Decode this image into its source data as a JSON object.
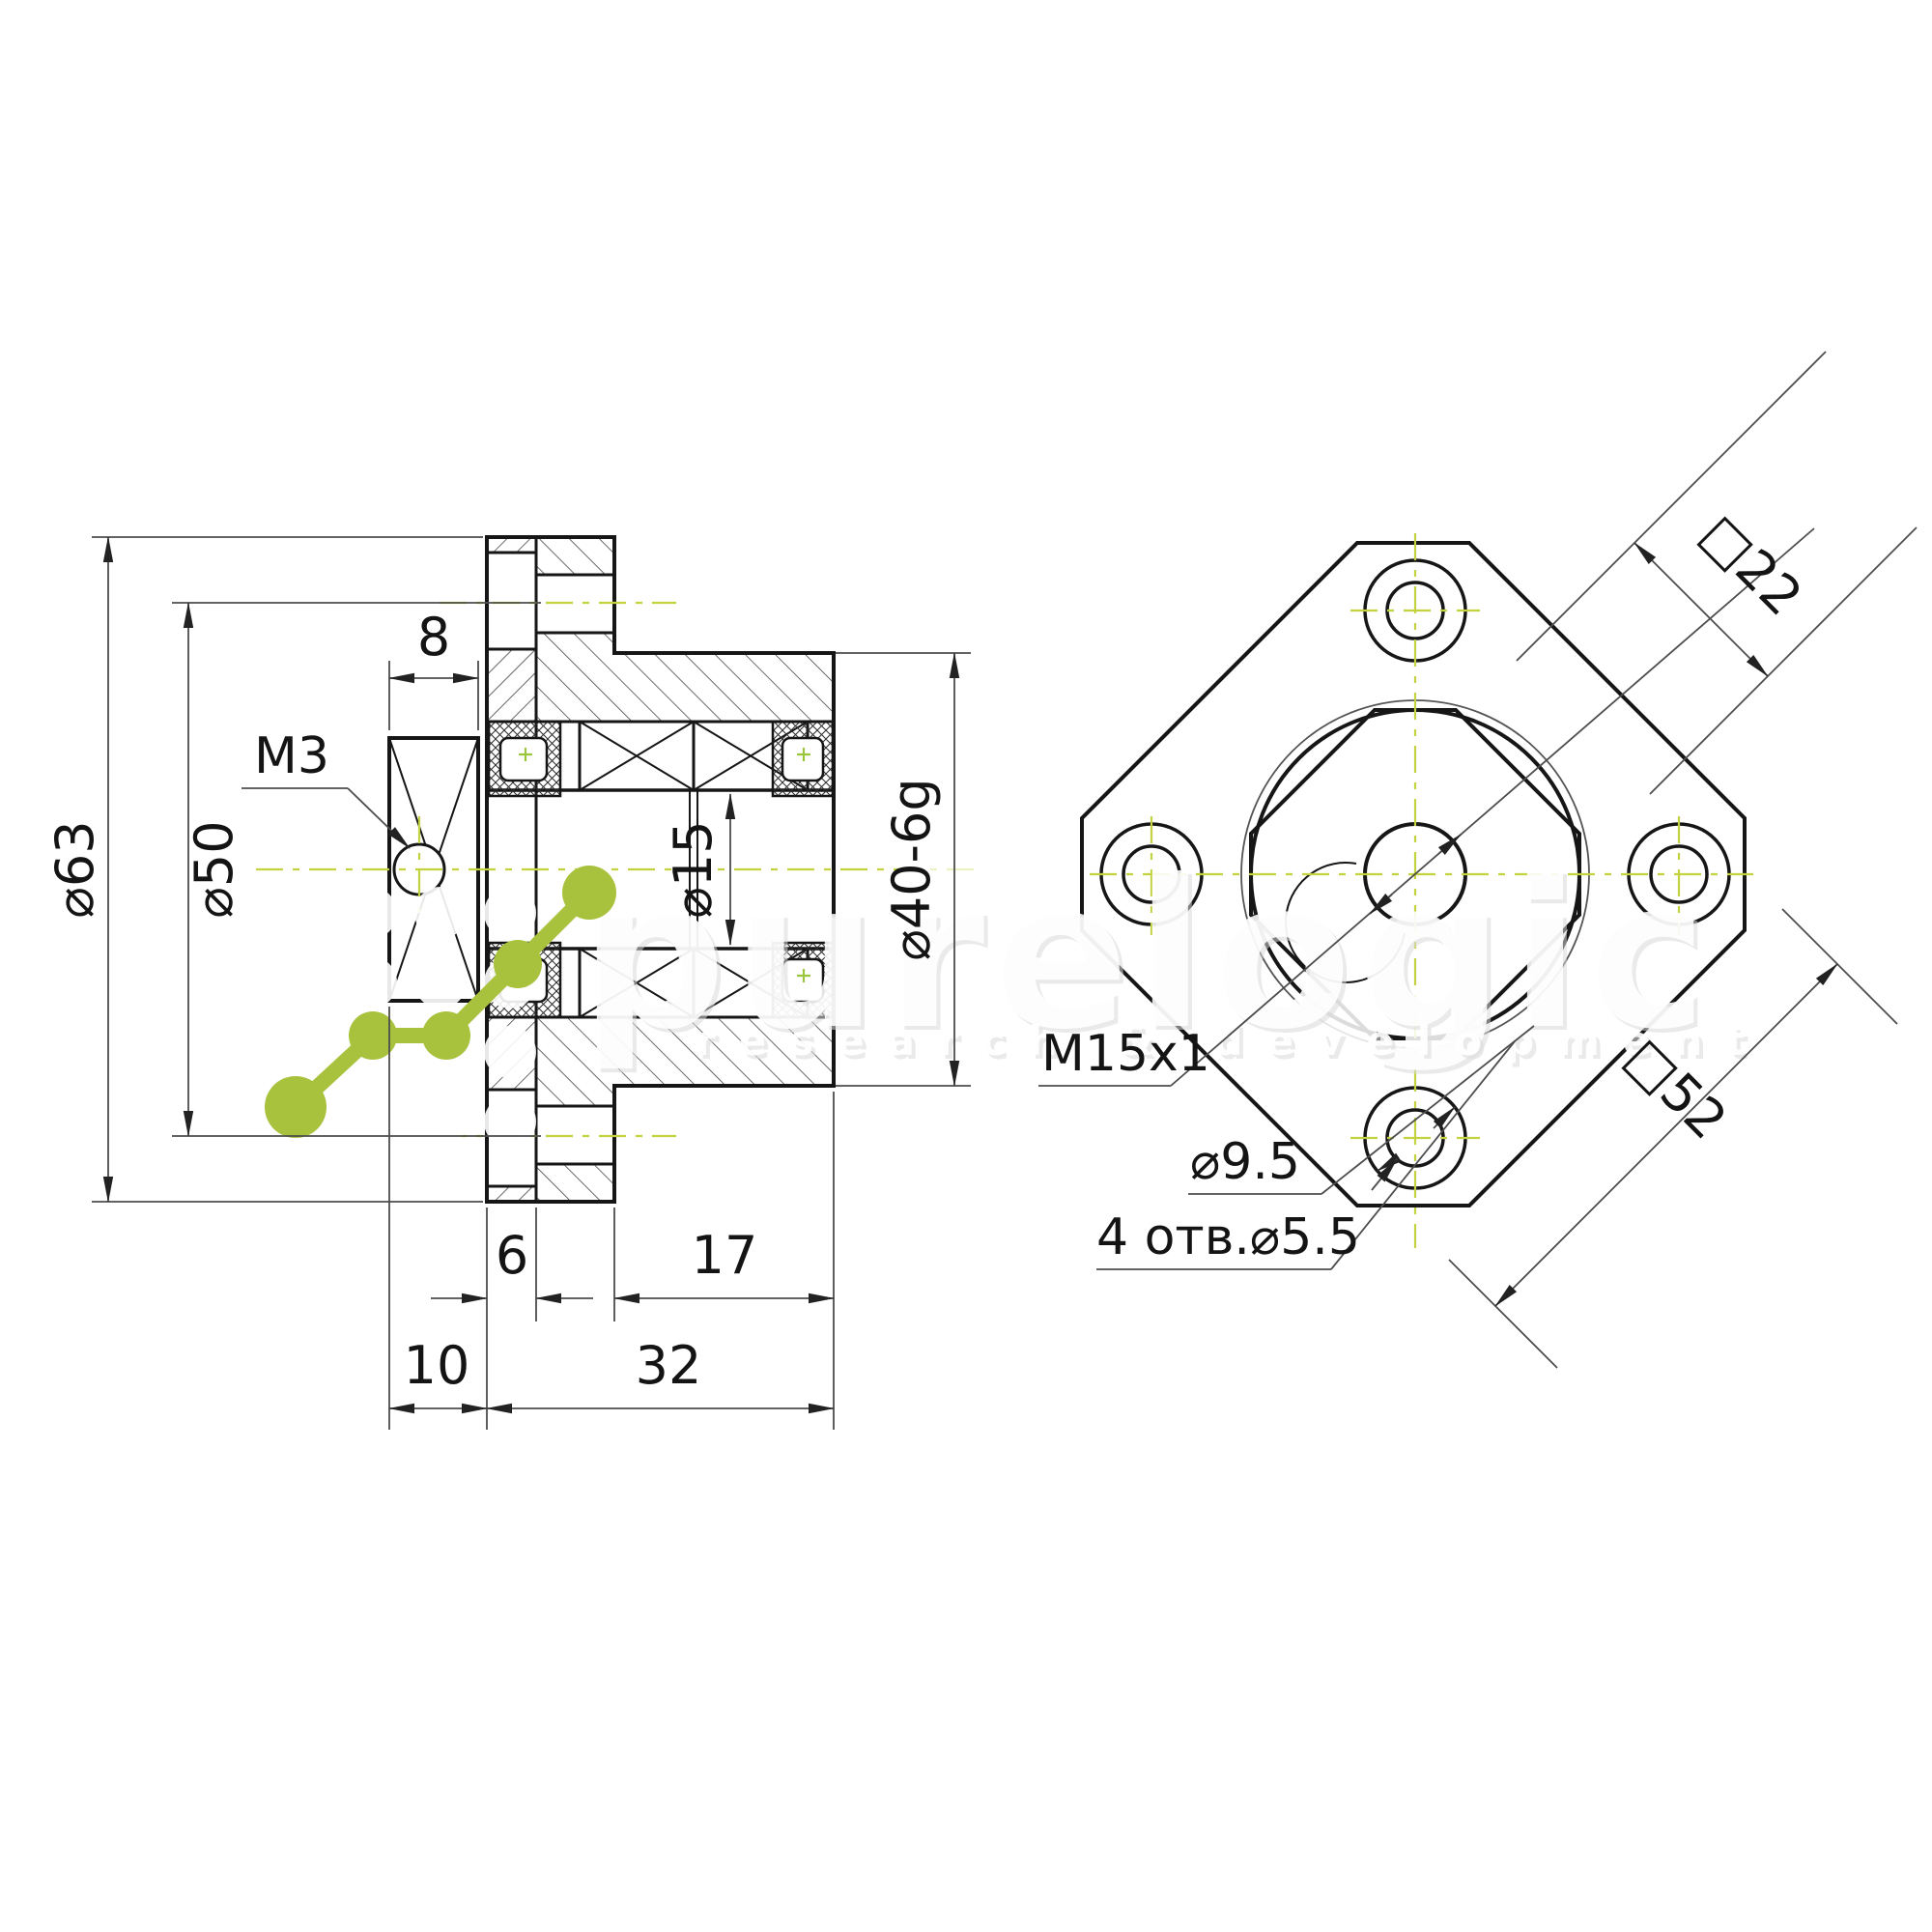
{
  "section": {
    "d63": "⌀63",
    "d50": "⌀50",
    "nut_width": "8",
    "set_screw": "M3",
    "bore": "⌀15",
    "body_od": "⌀40-6g",
    "flange_thickness": "6",
    "body_length": "17",
    "nut_offset": "10",
    "total_length": "32"
  },
  "front": {
    "flats": "□22",
    "square": "□52",
    "thread": "M15x1",
    "counterbore": "⌀9.5",
    "mount_holes": "4 отв.⌀5.5"
  },
  "watermark": {
    "brand": "purelogic",
    "tagline": "research & development"
  },
  "colors": {
    "line": "#161616",
    "dim": "#4d4d4d",
    "centerline": "#c3d23f",
    "logo_green": "#a9c23e"
  }
}
